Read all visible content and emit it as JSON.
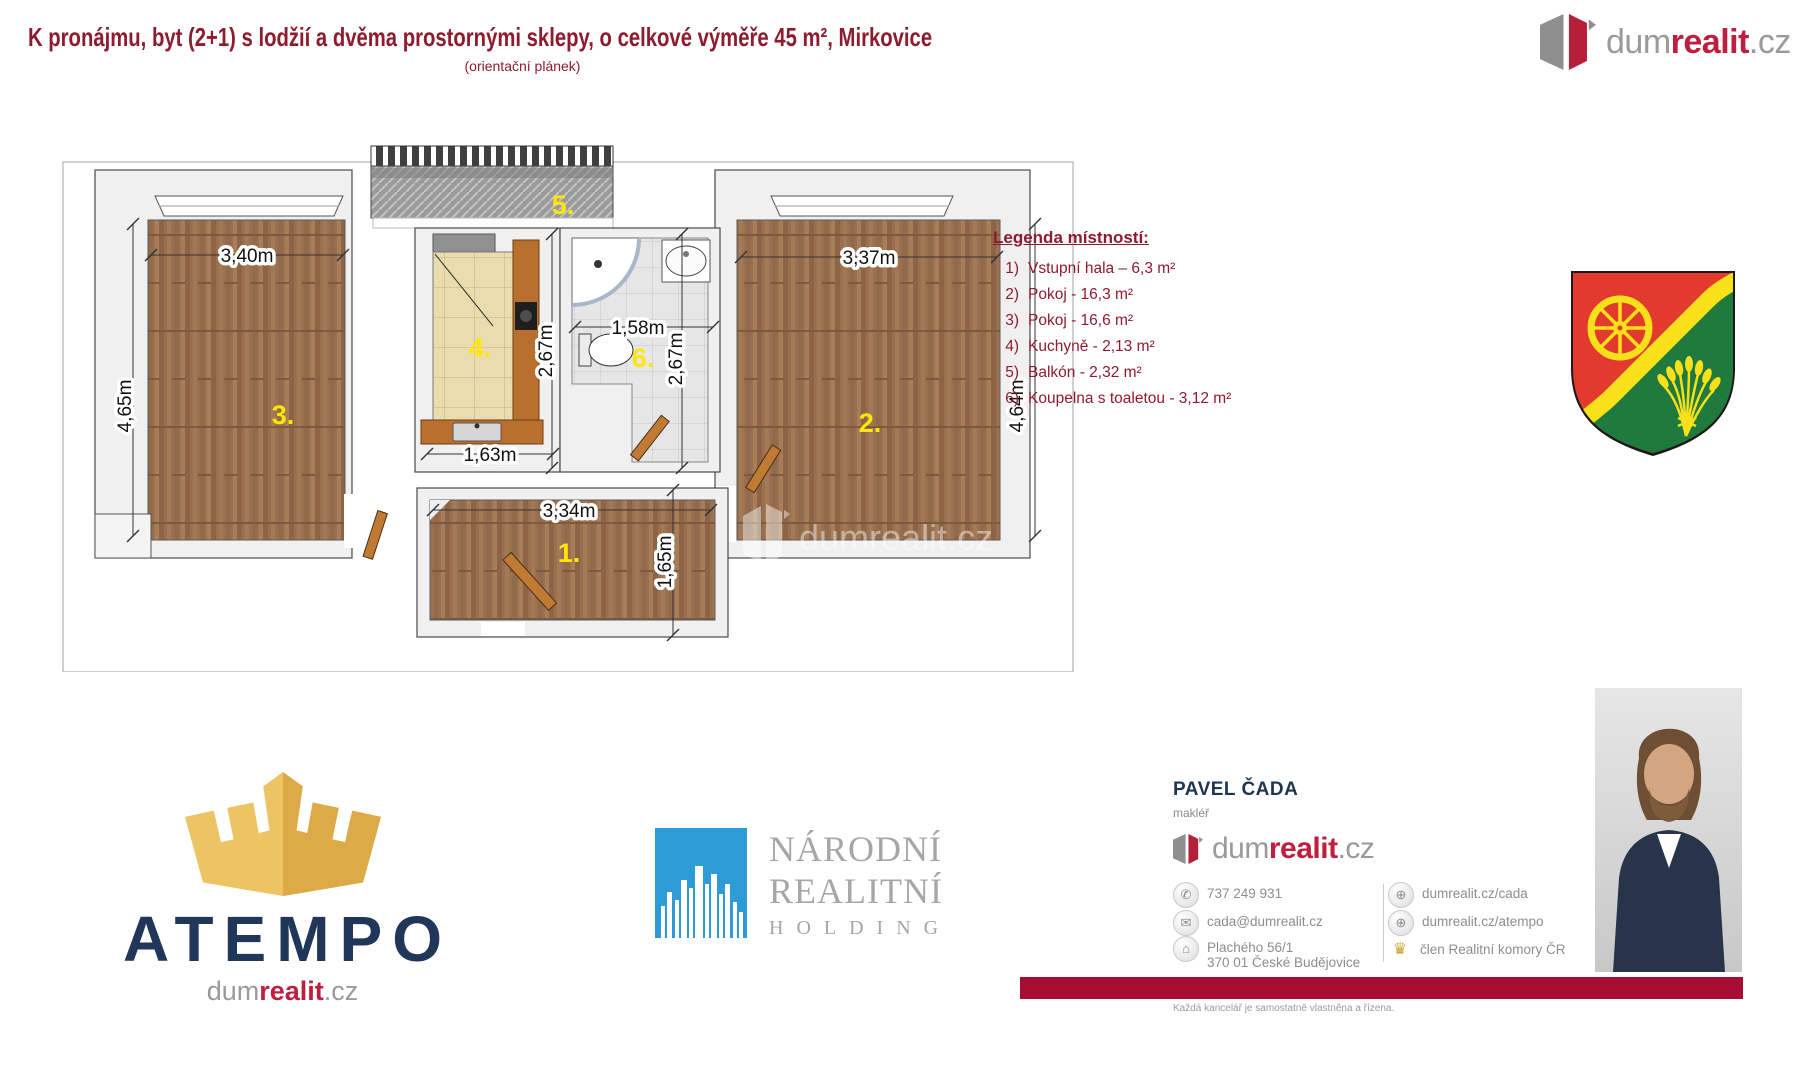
{
  "header": {
    "title": "K pronájmu, byt (2+1) s lodžií a dvěma prostornými sklepy, o celkové výměře 45 m², Mirkovice",
    "subtitle": "(orientační plánek)"
  },
  "brand": {
    "dum": "dum",
    "realit": "realit",
    "cz": ".cz"
  },
  "legend": {
    "heading": "Legenda místností:",
    "items": [
      {
        "num": "1)",
        "label": "Vstupní hala – 6,3 m²"
      },
      {
        "num": "2)",
        "label": "Pokoj - 16,3 m²"
      },
      {
        "num": "3)",
        "label": "Pokoj - 16,6 m²"
      },
      {
        "num": "4)",
        "label": "Kuchyně - 2,13 m²"
      },
      {
        "num": "5)",
        "label": "Balkón - 2,32 m²"
      },
      {
        "num": "6)",
        "label": "Koupelna s toaletou - 3,12 m²"
      }
    ]
  },
  "floorplan": {
    "labels": {
      "hall": "1.",
      "room2": "2.",
      "room3": "3.",
      "kitchen": "4.",
      "balcony": "5.",
      "bathroom": "6."
    },
    "dims": {
      "room3_width": "3,40m",
      "room3_height": "4,65m",
      "room2_width": "3,37m",
      "room2_height": "4,64m",
      "kitchen_height": "2,67m",
      "kitchen_width": "1,63m",
      "bathroom_width": "1,58m",
      "bathroom_height": "2,67m",
      "hall_width": "3,34m",
      "hall_height": "1,65m"
    },
    "watermark": "dumrealit.cz"
  },
  "atempo": {
    "name": "ATEMPO"
  },
  "narodni": {
    "line1": "NÁRODNÍ",
    "line2": "REALITNÍ",
    "line3": "HOLDING"
  },
  "agent": {
    "name": "PAVEL ČADA",
    "role": "makléř",
    "phone": "737 249 931",
    "email": "cada@dumrealit.cz",
    "address_line1": "Plachého 56/1",
    "address_line2": "370 01 České Budějovice",
    "web1": "dumrealit.cz/cada",
    "web2": "dumrealit.cz/atempo",
    "member": "člen Realitní komory ČR",
    "fineprint": "Každá kancelář je samostatně vlastněna a řízena."
  },
  "colors": {
    "dark_red": "#8e1b2e",
    "brand_red": "#bf1e3e",
    "bar_red": "#a60d33",
    "navy": "#20375a",
    "gold": "#ecc464",
    "blue": "#2d9cd6",
    "room_label_yellow": "#ffe608"
  }
}
